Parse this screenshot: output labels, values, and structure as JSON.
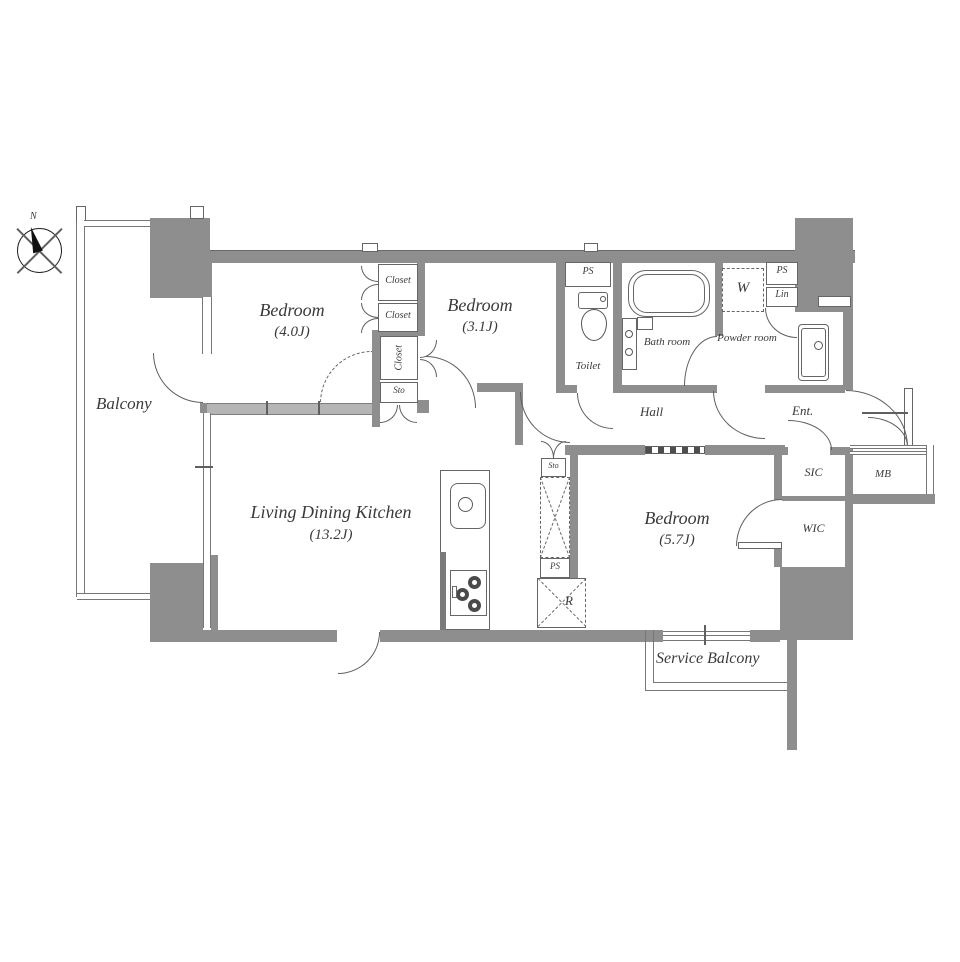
{
  "plan": {
    "compass_n": "N",
    "balcony": "Balcony",
    "service_balcony": "Service Balcony",
    "bedroom1": {
      "name": "Bedroom",
      "size": "(4.0J)"
    },
    "bedroom2": {
      "name": "Bedroom",
      "size": "(3.1J)"
    },
    "bedroom3": {
      "name": "Bedroom",
      "size": "(5.7J)"
    },
    "ldk": {
      "name": "Living Dining Kitchen",
      "size": "(13.2J)"
    },
    "hall": "Hall",
    "ent": "Ent.",
    "toilet": "Toilet",
    "bath": "Bath room",
    "powder": "Powder room",
    "washer": "W",
    "ps_toilet": "PS",
    "ps_powder": "PS",
    "ps_kitchen": "PS",
    "lin": "Lin",
    "closet_a": "Closet",
    "closet_b": "Closet",
    "closet_c": "Closet",
    "sto": "Sto",
    "sto_small": "Sto",
    "sic": "SIC",
    "wic": "WIC",
    "mb": "MB",
    "fridge": "R"
  },
  "colors": {
    "wall": "#8e8e8e",
    "light_wall": "#b5b5b5",
    "line": "#5f5f5f",
    "text": "#3a3a3a"
  }
}
